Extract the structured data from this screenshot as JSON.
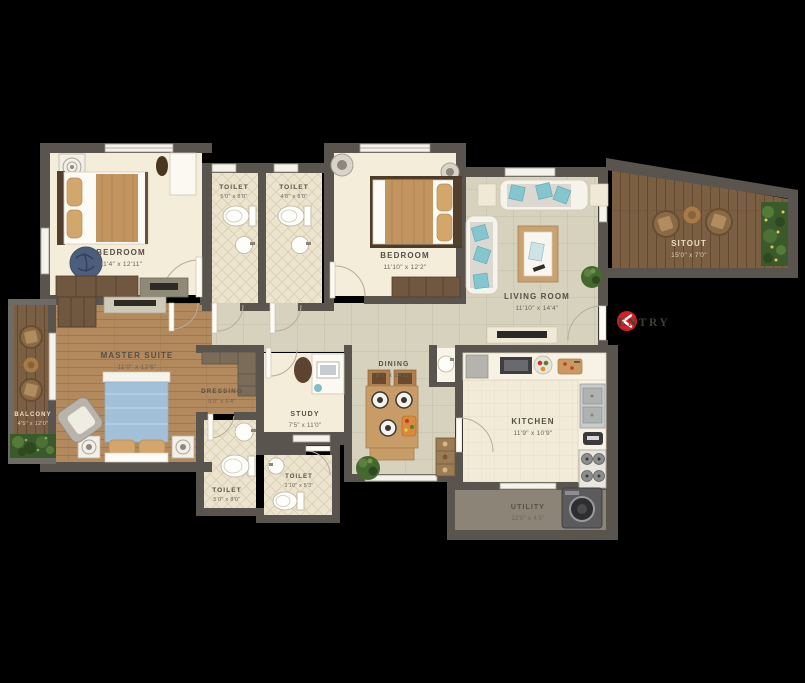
{
  "plan": {
    "entry": {
      "label": "ENTRY"
    },
    "rooms": {
      "bedroom1": {
        "name": "BEDROOM",
        "dims": "11'4\" x 12'11\""
      },
      "toilet1": {
        "name": "TOILET",
        "dims": "5'0\" x 8'0\""
      },
      "toilet2": {
        "name": "TOILET",
        "dims": "4'8\" x 8'0\""
      },
      "bedroom2": {
        "name": "BEDROOM",
        "dims": "11'10\" x 12'2\""
      },
      "living": {
        "name": "LIVING ROOM",
        "dims": "11'10\" x 14'4\""
      },
      "sitout": {
        "name": "SITOUT",
        "dims": "15'0\" x 7'0\""
      },
      "master": {
        "name": "MASTER SUITE",
        "dims": "11'0\" x 12'6\""
      },
      "dressing": {
        "name": "DRESSING",
        "dims": "5'0\" x 5'4\""
      },
      "balcony": {
        "name": "BALCONY",
        "dims": "4'5\" x 12'0\""
      },
      "study": {
        "name": "STUDY",
        "dims": "7'5\" x 11'0\""
      },
      "dining": {
        "name": "DINING",
        "dims": "8'7\" x 14'11\""
      },
      "toilet3": {
        "name": "TOILET",
        "dims": "5'0\" x 8'0\""
      },
      "toilet4": {
        "name": "TOILET",
        "dims": "3'10\" x 5'3\""
      },
      "kitchen": {
        "name": "KITCHEN",
        "dims": "11'9\" x 10'9\""
      },
      "utility": {
        "name": "UTILITY",
        "dims": "12'0\" x 4'5\""
      }
    },
    "colors": {
      "background": "#000000",
      "wall": "#5a544f",
      "floor_cream": "#f3edd9",
      "floor_tile": "#d7d2bd",
      "wood_light": "#b28a5d",
      "wood_dark": "#7a5f43",
      "entry_accent": "#d02127",
      "teal_cushion": "#84c5ce"
    }
  }
}
